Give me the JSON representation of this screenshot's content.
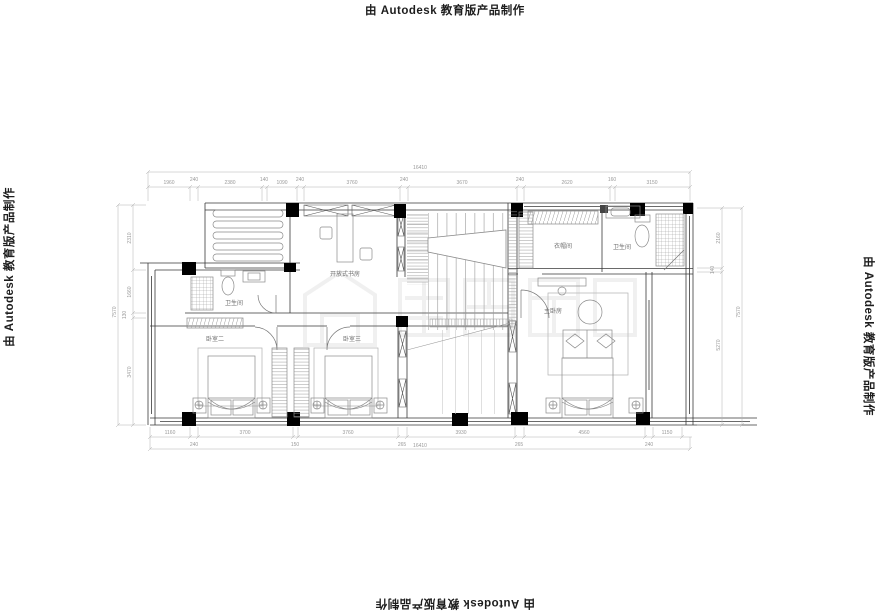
{
  "watermark": {
    "text": "由 Autodesk 教育版产品制作"
  },
  "plan": {
    "rooms": {
      "study": "开放式书房",
      "bath_left": "卫生间",
      "cloakroom": "衣帽间",
      "bath_right": "卫生间",
      "master": "主卧房",
      "bedroom2": "卧室二",
      "bedroom3": "卧室三"
    },
    "dims": {
      "top_total": "16410",
      "bottom_total": "16410",
      "left_total": "7570",
      "right_total": "7570",
      "top": [
        "1960",
        "240",
        "2380",
        "140",
        "1090",
        "240",
        "3760",
        "240",
        "3670",
        "240",
        "2620",
        "160",
        "3150"
      ],
      "bottom": [
        "1160",
        "240",
        "3700",
        "150",
        "3760",
        "265",
        "3930",
        "265",
        "4560",
        "240",
        "1150"
      ],
      "left": [
        "2310",
        "1660",
        "130",
        "3470"
      ],
      "right": [
        "2160",
        "140",
        "5270"
      ]
    }
  },
  "colors": {
    "wall": "#2f2f2f",
    "furniture": "#8a8a8a",
    "dimension": "#b0b0b0"
  }
}
